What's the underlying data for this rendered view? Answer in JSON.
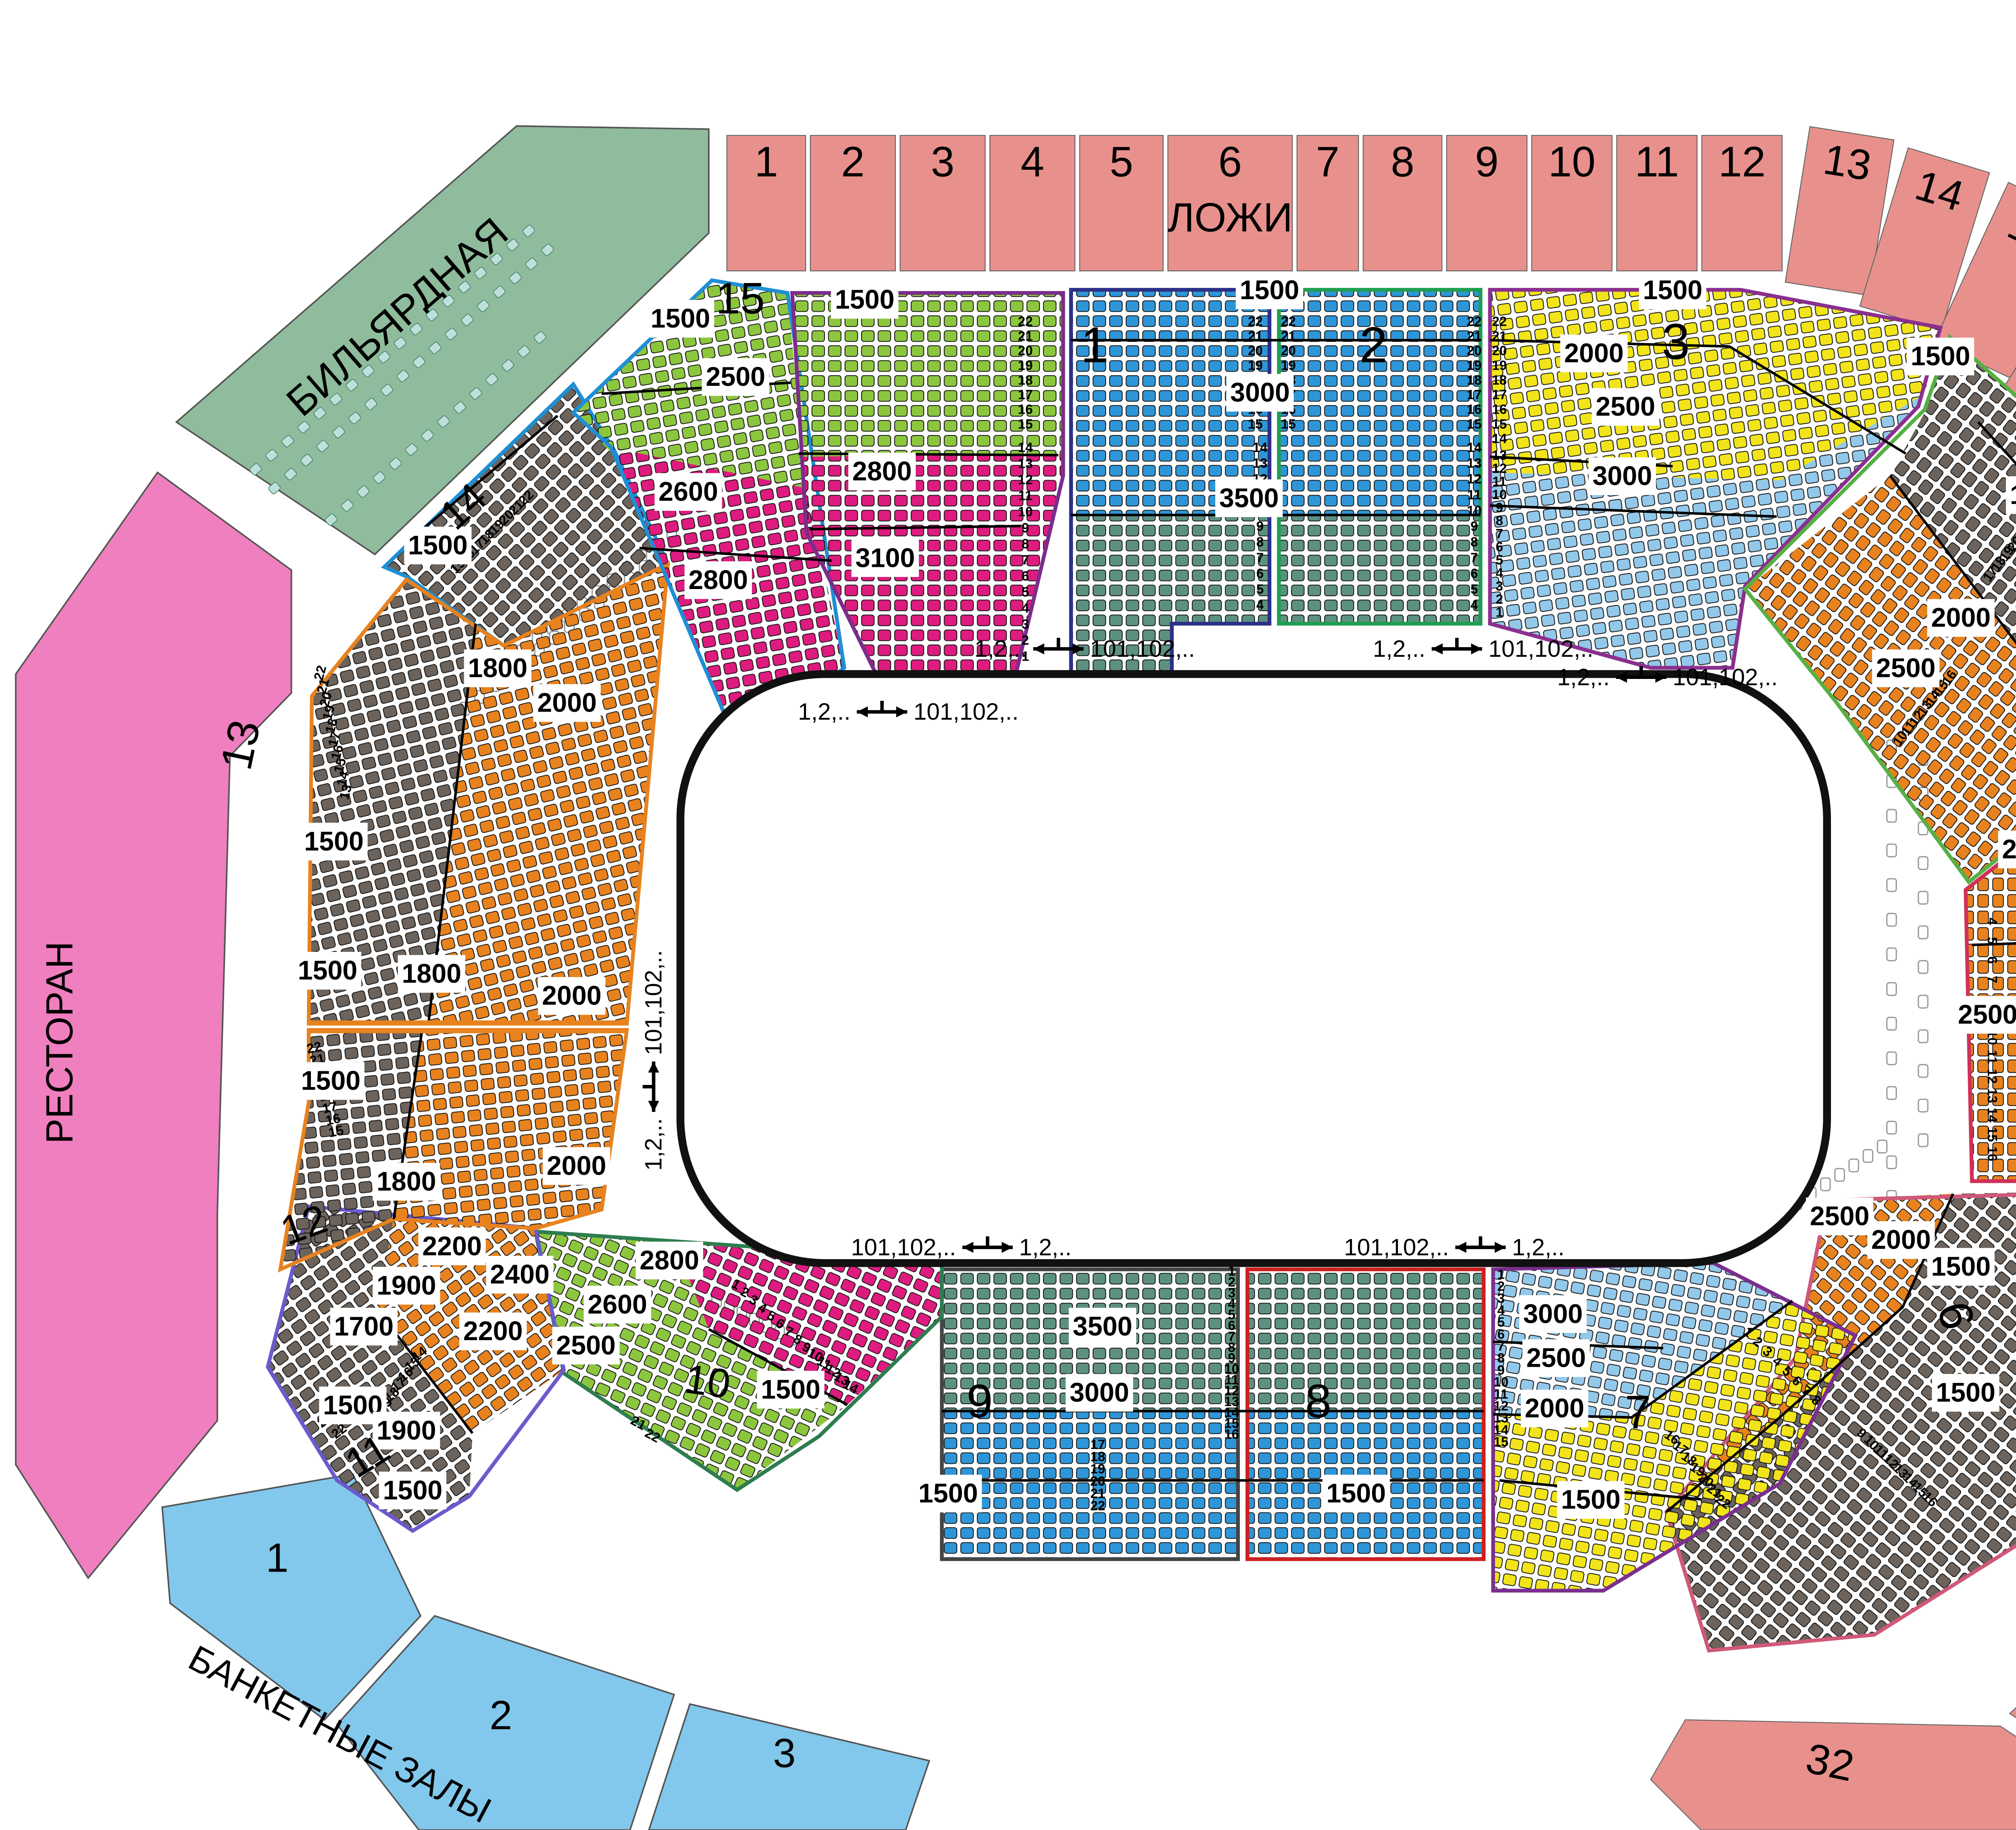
{
  "legend": {
    "loggia": "ЛОЖИ",
    "billiard": "БИЛЬЯРДНАЯ",
    "restaurant": "РЕСТОРАН",
    "banquet": "БАНКЕТНЫЕ ЗАЛЫ"
  },
  "seat_colors": {
    "blue": "#2E96D8",
    "teal": "#5C9181",
    "green": "#8CC63E",
    "magenta": "#DE1B7E",
    "yellow": "#F2E41A",
    "lightblue": "#92C8EA",
    "orange": "#E8821E",
    "gray": "#6B635C",
    "billiard": "#BFE0D8"
  },
  "area_colors": {
    "loggia": "#E8918C",
    "billiard": "#8FBC9C",
    "restaurant": "#EF7FBE",
    "banquet": "#82C8EC"
  },
  "loggia_boxes": {
    "top": [
      "1",
      "2",
      "3",
      "4",
      "5",
      "6",
      "7",
      "8",
      "9",
      "10",
      "11",
      "12"
    ],
    "arc": [
      "13",
      "14",
      "15",
      "16",
      "17",
      "18",
      "19",
      "20"
    ],
    "right": [
      "21",
      "22",
      "23",
      "24",
      "25",
      "26",
      "27"
    ],
    "corner": [
      "28",
      "29",
      "30",
      "31",
      "32"
    ]
  },
  "banquet_halls": [
    "1",
    "2",
    "3"
  ],
  "arrows": [
    {
      "left": "1,2,..",
      "right": "101,102,.."
    },
    {
      "left": "1,2,..",
      "right": "101,102,.."
    },
    {
      "left": "1,2,..",
      "right": "101,102,.."
    },
    {
      "left": "1,2,..",
      "right": "101,102,.."
    },
    {
      "left": "101,102,..",
      "right": "1,2,.."
    },
    {
      "left": "101,102,..",
      "right": "1,2,.."
    },
    {
      "left": "1,2,..",
      "right": "101,102,.."
    }
  ],
  "row_numbers": {
    "min": 1,
    "max": 22
  },
  "sectors": [
    {
      "id": "s14",
      "number": "14",
      "prices": [
        "1500"
      ],
      "bands": [
        "gray"
      ]
    },
    {
      "id": "s13",
      "number": "13",
      "prices": [
        "1500",
        "1800",
        "2000",
        "1500",
        "1800",
        "2000"
      ],
      "bands": [
        "gray",
        "orange"
      ]
    },
    {
      "id": "s15",
      "number": "15",
      "prices": [
        "1500",
        "2500",
        "2600",
        "2800"
      ],
      "bands": [
        "green",
        "magenta"
      ]
    },
    {
      "id": "sP",
      "number": "",
      "prices": [
        "1500",
        "2800",
        "3100"
      ],
      "bands": [
        "green",
        "magenta"
      ]
    },
    {
      "id": "s1",
      "number": "1",
      "prices": [
        "1500",
        "3000",
        "3500"
      ],
      "bands": [
        "blue",
        "teal"
      ]
    },
    {
      "id": "s2",
      "number": "2",
      "prices": [],
      "bands": [
        "blue",
        "teal"
      ]
    },
    {
      "id": "s3",
      "number": "3",
      "prices": [
        "1500",
        "2000",
        "2500",
        "3000"
      ],
      "bands": [
        "yellow",
        "lightblue"
      ]
    },
    {
      "id": "s4",
      "number": "4",
      "prices": [
        "1500",
        "1500",
        "2000",
        "2500"
      ],
      "bands": [
        "gray",
        "orange"
      ]
    },
    {
      "id": "s5",
      "number": "5",
      "prices": [
        "1500",
        "1500",
        "2000",
        "2500"
      ],
      "bands": [
        "orange",
        "gray"
      ]
    },
    {
      "id": "s6",
      "number": "6",
      "prices": [
        "2500",
        "2000",
        "1500",
        "1500"
      ],
      "bands": [
        "orange",
        "gray"
      ]
    },
    {
      "id": "s7",
      "number": "7",
      "prices": [
        "3000",
        "2500",
        "2000",
        "1500"
      ],
      "bands": [
        "lightblue",
        "yellow"
      ]
    },
    {
      "id": "s8",
      "number": "8",
      "prices": [
        "1500"
      ],
      "bands": [
        "teal",
        "blue"
      ]
    },
    {
      "id": "s9",
      "number": "9",
      "prices": [
        "3500",
        "3000",
        "1500"
      ],
      "bands": [
        "teal",
        "blue"
      ]
    },
    {
      "id": "s10",
      "number": "10",
      "prices": [
        "2800",
        "2600",
        "2500",
        "1500"
      ],
      "bands": [
        "magenta",
        "green"
      ]
    },
    {
      "id": "s11",
      "number": "11",
      "prices": [
        "2200",
        "2400",
        "1900",
        "1700",
        "2200",
        "1500",
        "1900",
        "1500"
      ],
      "bands": [
        "orange",
        "gray"
      ]
    },
    {
      "id": "s12",
      "number": "12",
      "prices": [
        "1500",
        "1800",
        "2000"
      ],
      "bands": [
        "gray",
        "orange"
      ]
    }
  ]
}
